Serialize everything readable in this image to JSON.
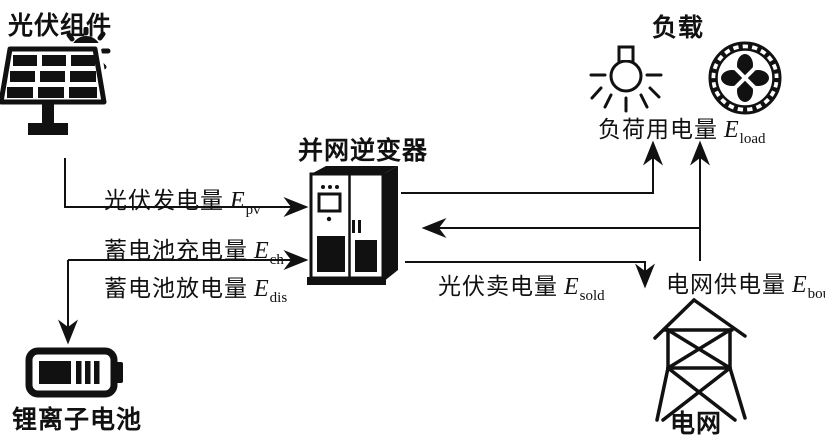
{
  "palette": {
    "ink": "#111111",
    "background": "#ffffff"
  },
  "nodes": {
    "pv_module": {
      "title": "光伏组件"
    },
    "inverter": {
      "title": "并网逆变器"
    },
    "load": {
      "title": "负载"
    },
    "battery": {
      "title": "锂离子电池"
    },
    "grid": {
      "title": "电网"
    }
  },
  "flows": {
    "pv_generation": {
      "label": "光伏发电量",
      "symbol": "E",
      "subscript": "pv"
    },
    "battery_charge": {
      "label": "蓄电池充电量",
      "symbol": "E",
      "subscript": "ch"
    },
    "battery_discharge": {
      "label": "蓄电池放电量",
      "symbol": "E",
      "subscript": "dis"
    },
    "pv_sold": {
      "label": "光伏卖电量",
      "symbol": "E",
      "subscript": "sold"
    },
    "grid_supply": {
      "label": "电网供电量",
      "symbol": "E",
      "subscript": "bou"
    },
    "load_consumption": {
      "label": "负荷用电量",
      "symbol": "E",
      "subscript": "load"
    }
  }
}
